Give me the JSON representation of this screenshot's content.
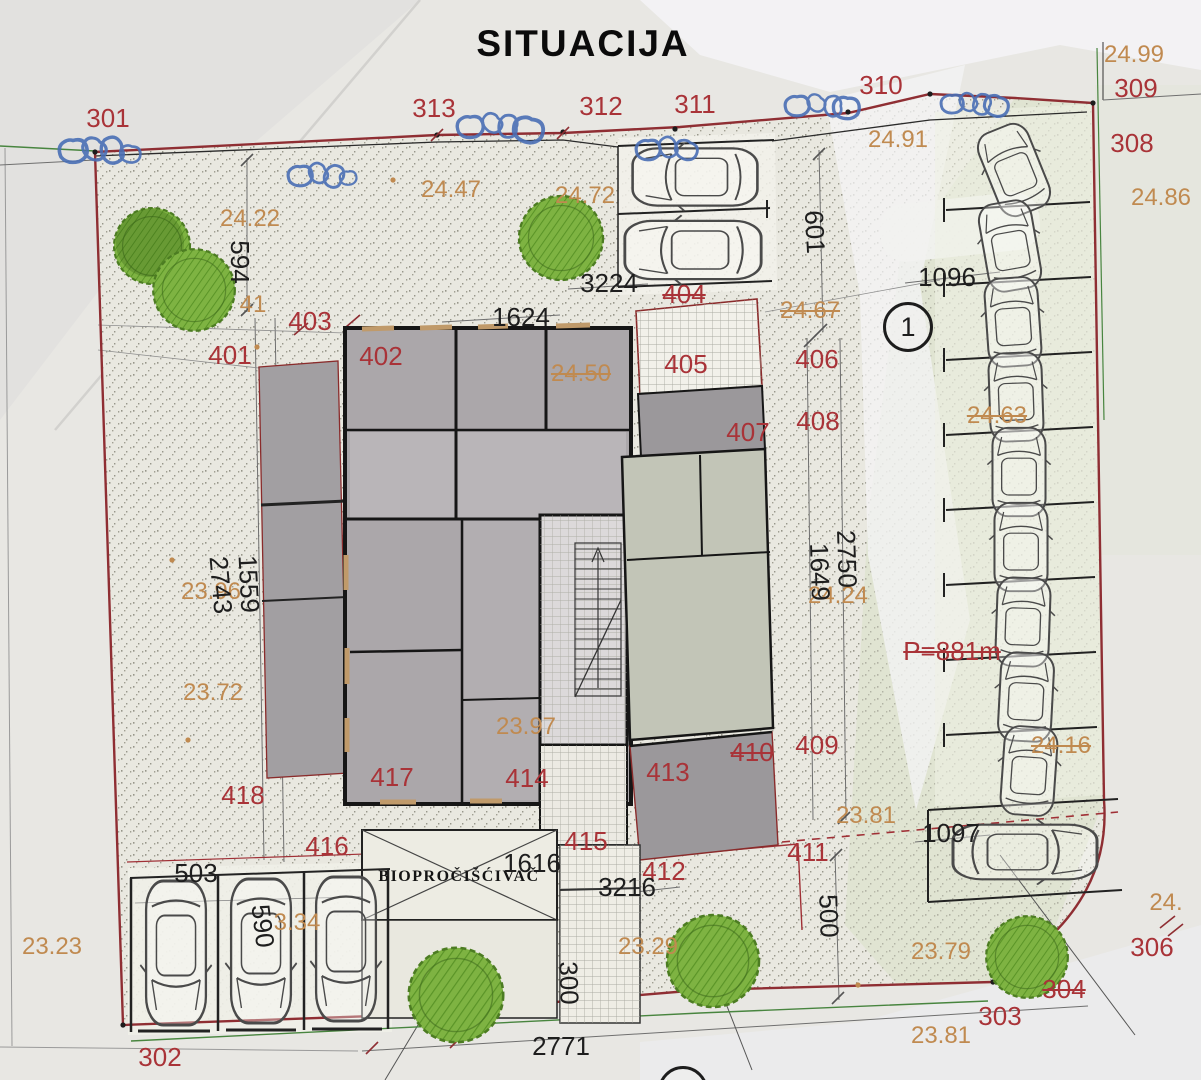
{
  "texts": {
    "title": "SITUACIJA",
    "bio": "BIOPROČIŠĆIVAČ",
    "markers": [
      "1",
      "2"
    ]
  },
  "colors": {
    "parcel_number": "#a93338",
    "elevation": "#c08a50",
    "dimension": "#1e1e1e",
    "boundary": "#8f2e33",
    "pen_annotation": "#4a6fb5",
    "tree": "#7eb342"
  },
  "labels": {
    "parcels": [
      {
        "t": "301",
        "x": 108,
        "y": 118
      },
      {
        "t": "313",
        "x": 434,
        "y": 108
      },
      {
        "t": "312",
        "x": 601,
        "y": 106
      },
      {
        "t": "311",
        "x": 695,
        "y": 104
      },
      {
        "t": "310",
        "x": 881,
        "y": 85
      },
      {
        "t": "309",
        "x": 1136,
        "y": 88
      },
      {
        "t": "308",
        "x": 1132,
        "y": 143
      },
      {
        "t": "401",
        "x": 230,
        "y": 355
      },
      {
        "t": "402",
        "x": 381,
        "y": 356
      },
      {
        "t": "403",
        "x": 310,
        "y": 321
      },
      {
        "t": "404",
        "x": 684,
        "y": 294,
        "strike": 1
      },
      {
        "t": "405",
        "x": 686,
        "y": 364
      },
      {
        "t": "406",
        "x": 817,
        "y": 359
      },
      {
        "t": "407",
        "x": 748,
        "y": 432
      },
      {
        "t": "408",
        "x": 818,
        "y": 421
      },
      {
        "t": "409",
        "x": 817,
        "y": 745
      },
      {
        "t": "410",
        "x": 752,
        "y": 752,
        "strike": 1
      },
      {
        "t": "411",
        "x": 808,
        "y": 852
      },
      {
        "t": "412",
        "x": 664,
        "y": 871
      },
      {
        "t": "413",
        "x": 668,
        "y": 772
      },
      {
        "t": "414",
        "x": 527,
        "y": 778
      },
      {
        "t": "415",
        "x": 586,
        "y": 841
      },
      {
        "t": "416",
        "x": 327,
        "y": 846
      },
      {
        "t": "417",
        "x": 392,
        "y": 777
      },
      {
        "t": "418",
        "x": 243,
        "y": 795
      },
      {
        "t": "302",
        "x": 160,
        "y": 1057
      },
      {
        "t": "303",
        "x": 1000,
        "y": 1016
      },
      {
        "t": "304",
        "x": 1064,
        "y": 989,
        "strike": 1
      },
      {
        "t": "306",
        "x": 1152,
        "y": 947
      },
      {
        "t": "P=881m",
        "x": 952,
        "y": 651,
        "strike": 1
      }
    ],
    "elevations": [
      {
        "t": "24.22",
        "x": 250,
        "y": 219
      },
      {
        "t": "24.47",
        "x": 451,
        "y": 190
      },
      {
        "t": "24.72",
        "x": 585,
        "y": 196
      },
      {
        "t": "24.91",
        "x": 898,
        "y": 140
      },
      {
        "t": "24.99",
        "x": 1134,
        "y": 55
      },
      {
        "t": "24.86",
        "x": 1161,
        "y": 198
      },
      {
        "t": "24.67",
        "x": 810,
        "y": 311,
        "strike": 1
      },
      {
        "t": "24.50",
        "x": 581,
        "y": 374,
        "strike": 1
      },
      {
        "t": "24.63",
        "x": 997,
        "y": 416,
        "strike": 1
      },
      {
        "t": "41",
        "x": 253,
        "y": 305
      },
      {
        "t": "23.96",
        "x": 211,
        "y": 592
      },
      {
        "t": "23.72",
        "x": 213,
        "y": 693
      },
      {
        "t": "23.97",
        "x": 526,
        "y": 727
      },
      {
        "t": "24.24",
        "x": 838,
        "y": 596
      },
      {
        "t": "24.16",
        "x": 1061,
        "y": 746,
        "strike": 1
      },
      {
        "t": "23.81",
        "x": 866,
        "y": 816
      },
      {
        "t": "23.79",
        "x": 941,
        "y": 952
      },
      {
        "t": "23.81",
        "x": 941,
        "y": 1036
      },
      {
        "t": "23.29",
        "x": 648,
        "y": 947
      },
      {
        "t": "23.23",
        "x": 52,
        "y": 947
      },
      {
        "t": "3.34",
        "x": 297,
        "y": 923
      },
      {
        "t": "24.",
        "x": 1166,
        "y": 903
      }
    ],
    "dimensions": [
      {
        "t": "594",
        "x": 240,
        "y": 262,
        "r": 90
      },
      {
        "t": "601",
        "x": 815,
        "y": 232,
        "r": 87
      },
      {
        "t": "3224",
        "x": 609,
        "y": 283
      },
      {
        "t": "1624",
        "x": 521,
        "y": 317
      },
      {
        "t": "1096",
        "x": 947,
        "y": 277
      },
      {
        "t": "1559",
        "x": 249,
        "y": 584,
        "r": 87
      },
      {
        "t": "2743",
        "x": 221,
        "y": 585,
        "r": 85
      },
      {
        "t": "2750",
        "x": 847,
        "y": 559,
        "r": 88
      },
      {
        "t": "1649",
        "x": 820,
        "y": 572,
        "r": 88
      },
      {
        "t": "500",
        "x": 829,
        "y": 916,
        "r": 88
      },
      {
        "t": "300",
        "x": 569,
        "y": 983,
        "r": 88
      },
      {
        "t": "3216",
        "x": 627,
        "y": 887
      },
      {
        "t": "1616",
        "x": 532,
        "y": 863
      },
      {
        "t": "1097",
        "x": 951,
        "y": 833
      },
      {
        "t": "503",
        "x": 196,
        "y": 873
      },
      {
        "t": "590",
        "x": 263,
        "y": 926,
        "r": 83
      },
      {
        "t": "2771",
        "x": 561,
        "y": 1046
      }
    ]
  }
}
